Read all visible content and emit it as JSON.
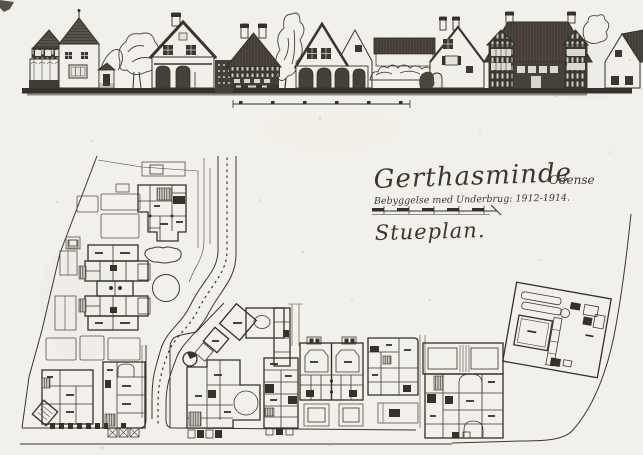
{
  "document": {
    "title": "Gerthasminde",
    "location": "Odense",
    "subtitle": "Bebyggelse med Underbrug: 1912-1914.",
    "plan_label": "Stueplan."
  },
  "colors": {
    "paper": "#f2f0ea",
    "ink": "#33302a",
    "roof_dark": "#4f4940"
  }
}
